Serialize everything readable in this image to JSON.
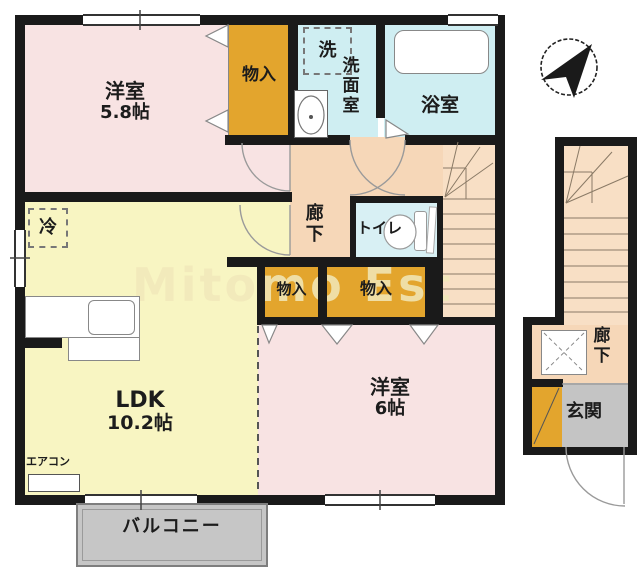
{
  "title": "2F apartment floor plan",
  "watermark": "Mitomo Est",
  "rooms": {
    "bedroom1": {
      "name": "洋室",
      "size": "5.8帖",
      "color": "#f8e3e3"
    },
    "bedroom2": {
      "name": "洋室",
      "size": "6帖",
      "color": "#f8e3e3"
    },
    "ldk": {
      "name": "LDK",
      "size": "10.2帖",
      "color": "#f8f5c2"
    },
    "washroom": {
      "name": "洗面室",
      "color": "#cfeef2"
    },
    "bathroom": {
      "name": "浴室",
      "color": "#cfeef2"
    },
    "toilet": {
      "name": "トイレ",
      "color": "#d8f0f4"
    },
    "corridor_main": {
      "name": "廊下",
      "color": "#f6d7b8"
    },
    "corridor_entry": {
      "name": "廊下",
      "color": "#f6d7b8"
    },
    "entrance": {
      "name": "玄関",
      "color": "#c4c4c4"
    },
    "balcony": {
      "name": "バルコニー",
      "color": "#c6c6c6"
    },
    "closet_top": {
      "name": "物入",
      "color": "#e3a52d"
    },
    "closet_left": {
      "name": "物入",
      "color": "#e3a52d"
    },
    "closet_right": {
      "name": "物入",
      "color": "#e3a52d"
    },
    "laundry": {
      "name": "洗"
    },
    "fridge": {
      "name": "冷"
    },
    "aircon": {
      "name": "エアコン"
    }
  }
}
